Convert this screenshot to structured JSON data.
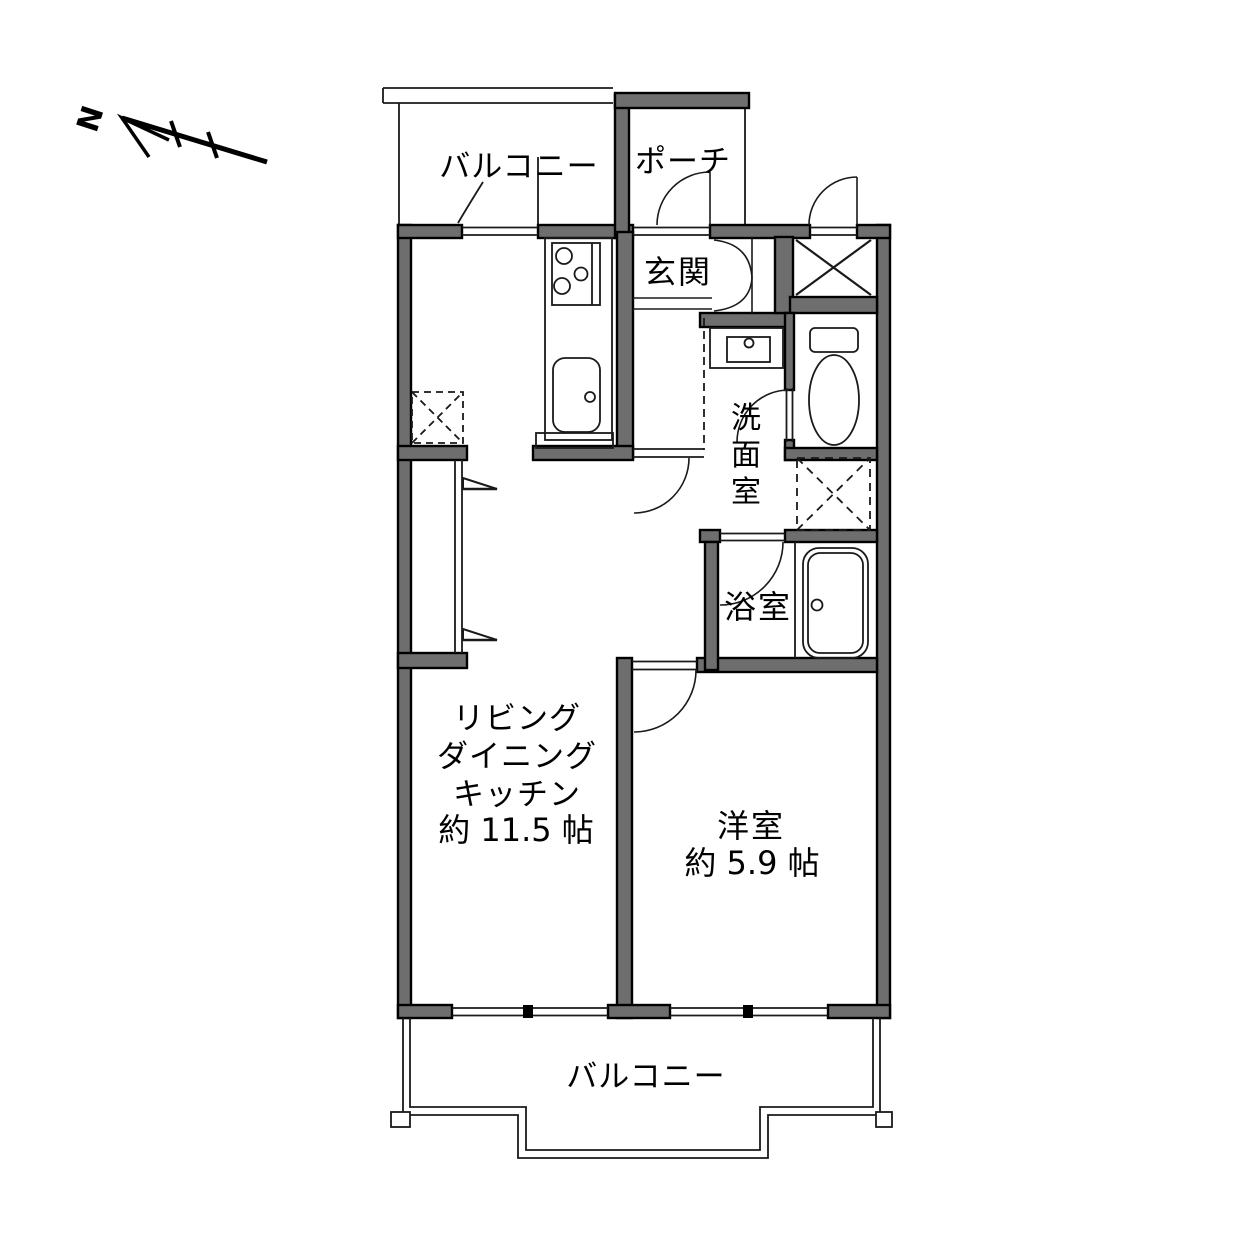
{
  "diagram_type": "apartment-floorplan",
  "compass": {
    "north_label": "N"
  },
  "rooms": {
    "balcony_top": {
      "label": "バルコニー"
    },
    "porch": {
      "label": "ポーチ"
    },
    "entrance": {
      "label": "玄関"
    },
    "washroom": {
      "label": "洗面室",
      "chars": [
        "洗",
        "面",
        "室"
      ]
    },
    "bathroom": {
      "label": "浴室"
    },
    "ldk": {
      "line1": "リビング",
      "line2": "ダイニング",
      "line3": "キッチン",
      "area": "約 11.5 帖"
    },
    "western_room": {
      "label": "洋室",
      "area": "約 5.9 帖"
    },
    "balcony_bottom": {
      "label": "バルコニー"
    }
  },
  "colors": {
    "background": "#ffffff",
    "wall_fill": "#6e6e6e",
    "wall_stroke": "#000000",
    "line": "#1a1a1a"
  }
}
